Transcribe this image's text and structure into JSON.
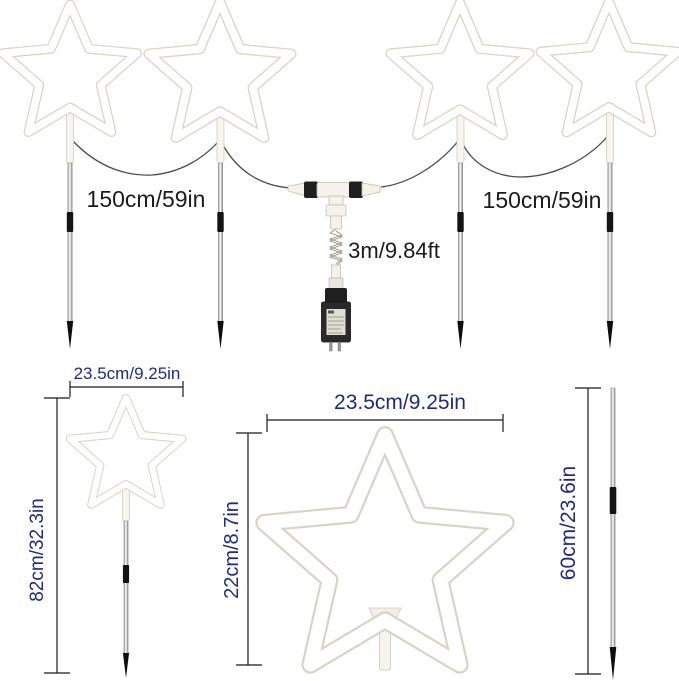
{
  "diagram": {
    "top_row": {
      "star_lights_count": 4,
      "left_spacing_label": "150cm/59in",
      "right_spacing_label": "150cm/59in",
      "power_cord_label": "3m/9.84ft"
    },
    "detail_views": {
      "small_star": {
        "width_label": "23.5cm/9.25in",
        "height_label": "82cm/32.3in"
      },
      "large_star": {
        "width_label": "23.5cm/9.25in",
        "height_label": "22cm/8.7in"
      },
      "ground_stake": {
        "height_label": "60cm/23.6in"
      }
    }
  },
  "colors": {
    "background": "#ffffff",
    "measurement_text_black": "#1b1b1b",
    "measurement_text_blue": "#232a7d",
    "star_outline": "#d7d3c7",
    "stake_black": "#141414",
    "wire": "#4b4b4b"
  }
}
